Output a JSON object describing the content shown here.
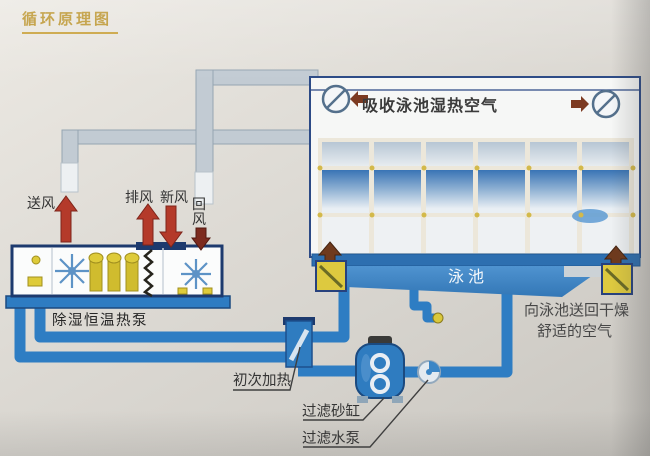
{
  "title": "循环原理图",
  "room": {
    "absorb_label": "吸收泳池湿热空气",
    "pool_label": "泳池",
    "note_line1": "向泳池送回干燥",
    "note_line2": "舒适的空气"
  },
  "unit": {
    "label": "除湿恒温热泵",
    "supply_air": "送风",
    "exhaust_air": "排风",
    "fresh_air": "新风",
    "return_air": "回风"
  },
  "water_loop": {
    "initial_heating": "初次加热",
    "sand_filter": "过滤砂缸",
    "filter_pump": "过滤水泵"
  },
  "icons": {
    "fan_vent": "⊘",
    "up_arrow": "▲",
    "down_arrow": "▼"
  },
  "colors": {
    "accent_gold": "#bd9733",
    "pipe_blue": "#2e7dc3",
    "pool_blue": "#3679b8",
    "arrow_red": "#b43a2a",
    "arrow_maroon": "#7c2a1e",
    "vent_yellow": "#ddc93f",
    "outline_navy": "#1d3a6e"
  }
}
